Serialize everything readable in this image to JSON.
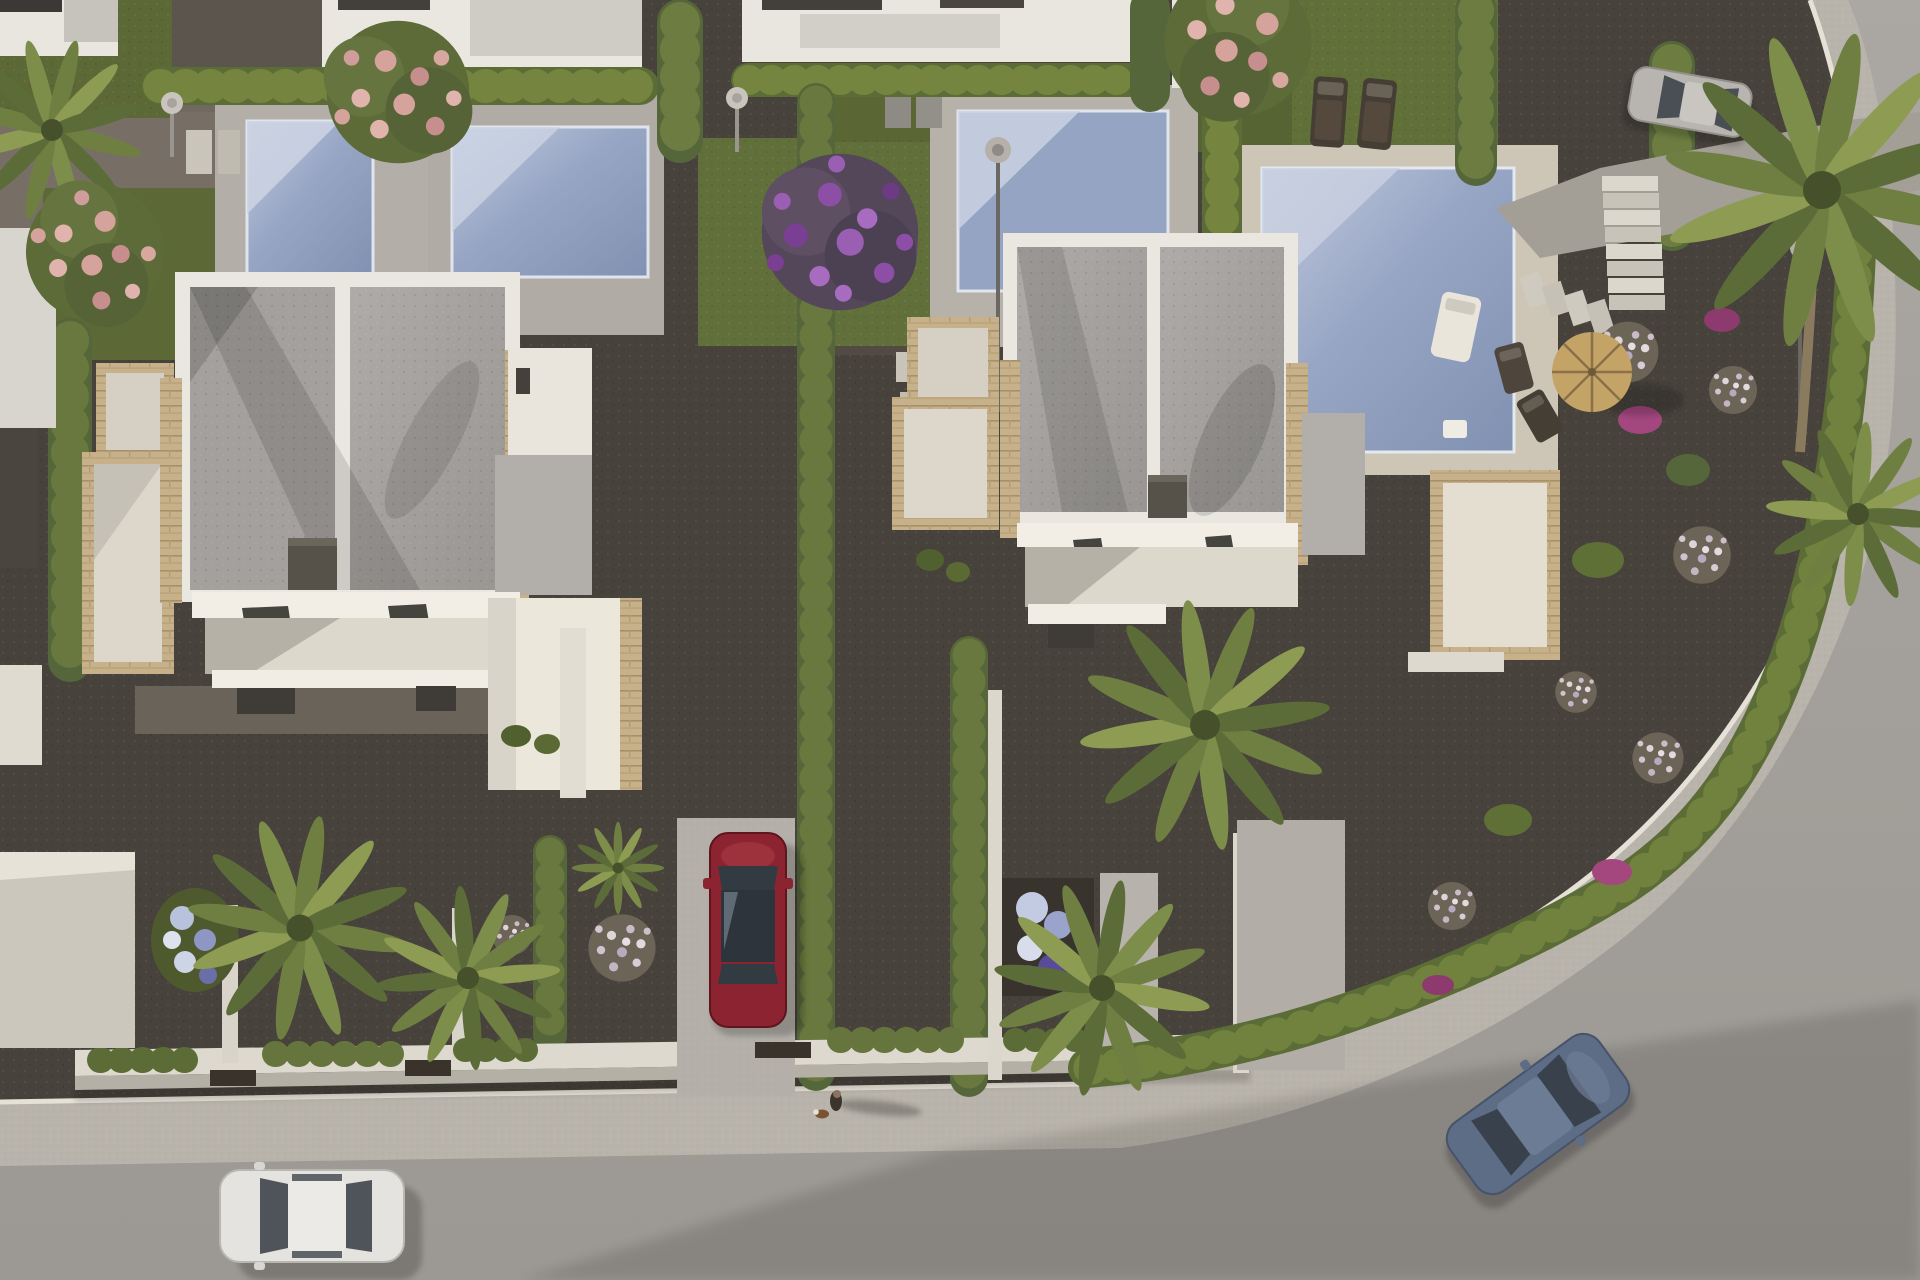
{
  "scene": {
    "title": "Aerial 3D architectural rendering of a modern villa development",
    "view": "top-down aerial, late-afternoon sun with long shadows cast to the right",
    "setting": "Two detached white flat-roof villas with private pools and landscaped gardens along a curved residential street"
  },
  "palette": {
    "gravel_dark": "#47423b",
    "gravel_mid": "#59544c",
    "gravel_path": "#7b756c",
    "grass": "#5c6836",
    "grass_light": "#6e7a3e",
    "hedge": "#5b6c36",
    "hedge_light": "#75853f",
    "hedge_dark": "#49582c",
    "cypress": "#55663a",
    "pool_deck": "#b3afa8",
    "pool_deck_cream": "#cdc6b7",
    "pool_water": "#96a4c4",
    "pool_water_light": "#ccd4e3",
    "roof_gravel": "#a3a09d",
    "parapet_white": "#eae7e0",
    "facade_white": "#f2eee5",
    "stone_tan": "#c6b18a",
    "terrace_cream": "#ddd7cb",
    "annex_roof": "#b2afab",
    "road": "#a6a29d",
    "sidewalk": "#b9b4ab",
    "curb": "#e5e1d7",
    "chimney": "#575249",
    "car_red": "#8c2330",
    "car_white": "#e4e3df",
    "car_blue": "#5d6d86",
    "car_silver": "#b8b5b0",
    "umbrella_straw": "#c4a366",
    "blossom_pink": "#d5a29c",
    "blossom_purple": "#8d4fa5",
    "blossom_magenta": "#a4477f",
    "palm_green": "#6f7f42",
    "flower_white_blue": "#b9c2dd",
    "gate_dark": "#3a332c",
    "wall_white": "#ded9cf"
  },
  "objects": {
    "villas": [
      {
        "id": "left-villa",
        "description": "white villa, flat gravel roof split in two halves by white dividing wall, dark rooftop chimney, stone-clad side terraces, skylights and porch below"
      },
      {
        "id": "right-villa",
        "description": "white villa, flat gravel roof split in two halves by white dividing wall, dark rooftop chimney, stone-clad terraces, skylights and porch below"
      }
    ],
    "pools": [
      {
        "id": "pool-top-left-1",
        "deck": "grey stone deck"
      },
      {
        "id": "pool-top-left-2",
        "deck": "grey stone deck"
      },
      {
        "id": "pool-top-center",
        "deck": "grey stone deck with lamp post"
      },
      {
        "id": "pool-top-right",
        "deck": "cream deck with white sun lounger and side table"
      }
    ],
    "cars": [
      {
        "color_name": "white",
        "position": "street bottom-left, driving west"
      },
      {
        "color_name": "dark red",
        "position": "parked nose-in on left villa driveway"
      },
      {
        "color_name": "blue-grey",
        "position": "street bottom-right, driving up the curve"
      },
      {
        "color_name": "silver",
        "position": "parked on top-right driveway"
      }
    ],
    "pedestrian": {
      "description": "person walking a small brown-and-white dog",
      "position": "sidewalk bottom-center, long shadow to the right"
    },
    "street_furniture": {
      "sun_loungers_dark": 2,
      "deck_chairs": 2,
      "white_lounger": 1,
      "straw_umbrella": 1,
      "outdoor_showers": 2,
      "lamp_posts": 2,
      "stair_steps": "white stone staircase, top-right garden",
      "stepping_stones": "flagstone paths"
    },
    "vegetation": {
      "pink_flowering_trees": 3,
      "purple_flowering_tree": 1,
      "magenta_bougainvillea_patches": 4,
      "palms": 7,
      "flower_ball_shrubs": 7,
      "hedges": "clipped cypress/boxwood hedgerows between plots and along the curved street",
      "white_blue_flower_beds": 2
    },
    "road": {
      "description": "smooth asphalt street curving from bottom-left up to top-right, bordered by speckled sidewalk with white kerb and low white garden walls with dark gates"
    }
  }
}
